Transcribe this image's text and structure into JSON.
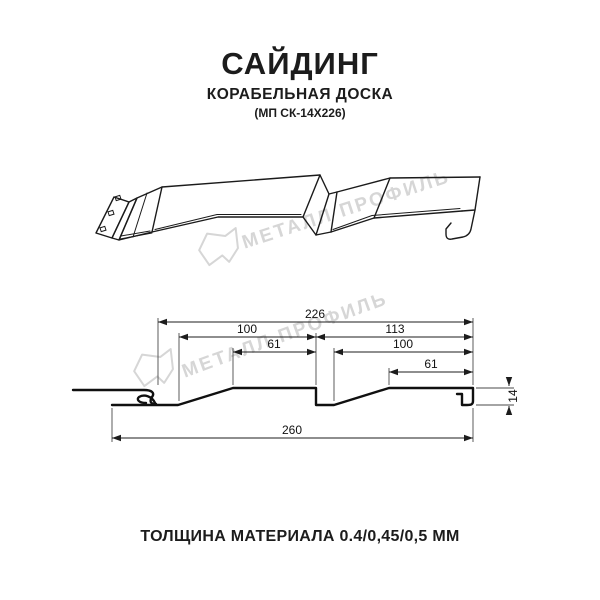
{
  "page": {
    "background": "#ffffff",
    "line_color": "#1b1b1b"
  },
  "header": {
    "title": "САЙДИНГ",
    "subtitle": "КОРАБЕЛЬНАЯ ДОСКА",
    "model_code": "(МП СК-14Х226)"
  },
  "watermark": {
    "brand_text": "МЕТАЛЛ ПРОФИЛЬ",
    "logo_icon": "metall-profil-logo",
    "color": "#d6d6d6"
  },
  "cross_section": {
    "dimensions": {
      "overall_top": "226",
      "left_board_total": "100",
      "right_board_total": "113",
      "left_board_flat": "61",
      "right_board_inner": "100",
      "right_board_flat": "61",
      "overall_bottom": "260",
      "profile_height": "14"
    }
  },
  "footer": {
    "thickness_note": "ТОЛЩИНА МАТЕРИАЛА 0.4/0,45/0,5 ММ"
  }
}
